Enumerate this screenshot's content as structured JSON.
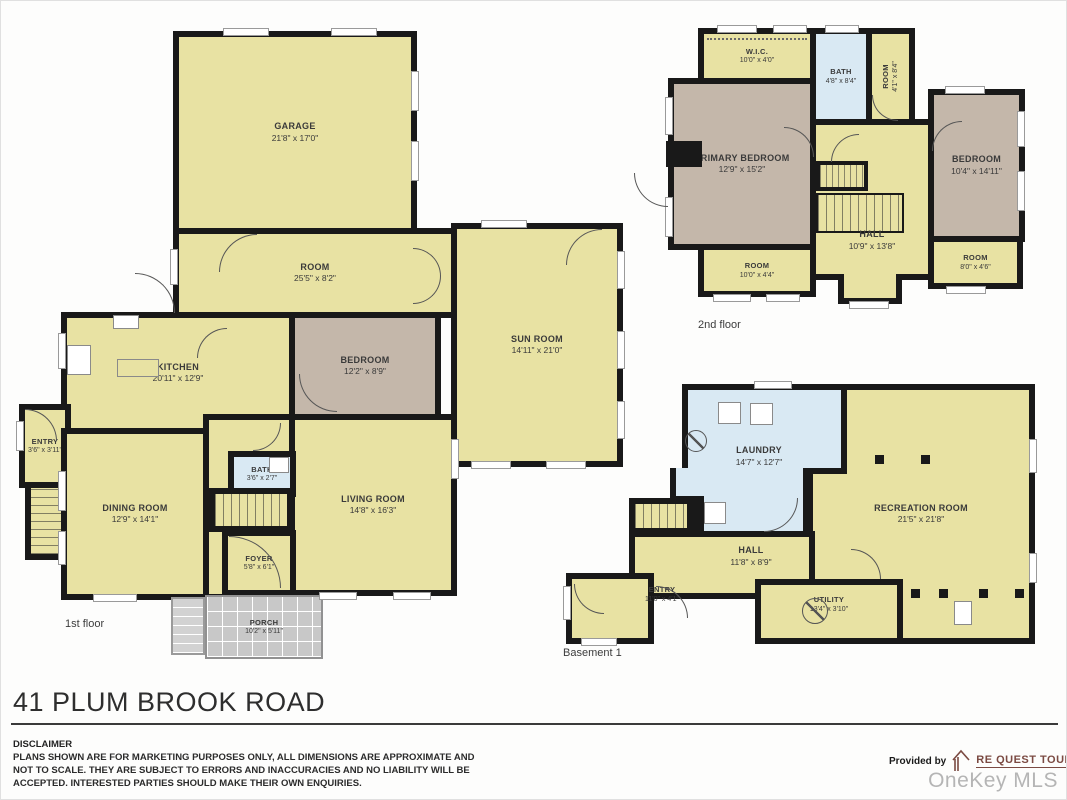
{
  "page": {
    "title": "41 PLUM BROOK ROAD",
    "watermark": "OneKey MLS"
  },
  "disclaimer": {
    "heading": "DISCLAIMER",
    "line1": "PLANS SHOWN ARE FOR MARKETING PURPOSES ONLY, ALL DIMENSIONS ARE APPROXIMATE AND",
    "line2": "NOT TO SCALE. THEY ARE SUBJECT TO ERRORS AND INACCURACIES AND NO LIABILITY WILL BE",
    "line3": "ACCEPTED. INTERESTED PARTIES SHOULD MAKE THEIR OWN ENQUIRIES."
  },
  "provider": {
    "prefix": "Provided by",
    "name": "RE QUEST TOURS",
    "phone": "516-984-6030"
  },
  "floor1": {
    "label": "1st floor",
    "garage": {
      "name": "GARAGE",
      "dims": "21'8\" x 17'0\""
    },
    "room": {
      "name": "ROOM",
      "dims": "25'5\" x 8'2\""
    },
    "sunroom": {
      "name": "SUN ROOM",
      "dims": "14'11\" x 21'0\""
    },
    "kitchen": {
      "name": "KITCHEN",
      "dims": "20'11\" x 12'9\""
    },
    "bedroom": {
      "name": "BEDROOM",
      "dims": "12'2\" x 8'9\""
    },
    "entry": {
      "name": "ENTRY",
      "dims": "3'6\" x 3'11\""
    },
    "dining": {
      "name": "DINING ROOM",
      "dims": "12'9\" x 14'1\""
    },
    "bath": {
      "name": "BATH",
      "dims": "3'6\" x 2'7\""
    },
    "living": {
      "name": "LIVING ROOM",
      "dims": "14'8\" x 16'3\""
    },
    "foyer": {
      "name": "FOYER",
      "dims": "5'8\" x 6'1\""
    },
    "porch": {
      "name": "PORCH",
      "dims": "10'2\" x 5'11\""
    }
  },
  "floor2": {
    "label": "2nd floor",
    "wic": {
      "name": "W.I.C.",
      "dims": "10'0\" x 4'0\""
    },
    "bath": {
      "name": "BATH",
      "dims": "4'8\" x 8'4\""
    },
    "room_side": {
      "name": "ROOM",
      "dims": "4'1\" x 8'4\""
    },
    "primary": {
      "name": "PRIMARY BEDROOM",
      "dims": "12'9\" x 15'2\""
    },
    "hall": {
      "name": "HALL",
      "dims": "10'9\" x 13'8\""
    },
    "bedroom": {
      "name": "BEDROOM",
      "dims": "10'4\" x 14'11\""
    },
    "room_bl": {
      "name": "ROOM",
      "dims": "10'0\" x 4'4\""
    },
    "room_br": {
      "name": "ROOM",
      "dims": "8'0\" x 4'6\""
    }
  },
  "basement": {
    "label": "Basement 1",
    "laundry": {
      "name": "LAUNDRY",
      "dims": "14'7\" x 12'7\""
    },
    "recreation": {
      "name": "RECREATION ROOM",
      "dims": "21'5\" x 21'8\""
    },
    "hall": {
      "name": "HALL",
      "dims": "11'8\" x 8'9\""
    },
    "entry": {
      "name": "ENTRY",
      "dims": "11'0\" x 4'1\""
    },
    "utility": {
      "name": "UTILITY",
      "dims": "13'4\" x 3'10\""
    }
  },
  "colors": {
    "room_fill": "#e8e2a3",
    "bedroom_fill": "#c4b7aa",
    "wet_fill": "#d9e9f3",
    "wall": "#191919",
    "porch_fill": "#c8c8c8",
    "logo_maroon": "#7b4a42",
    "watermark_gray": "#b5b5b5"
  }
}
